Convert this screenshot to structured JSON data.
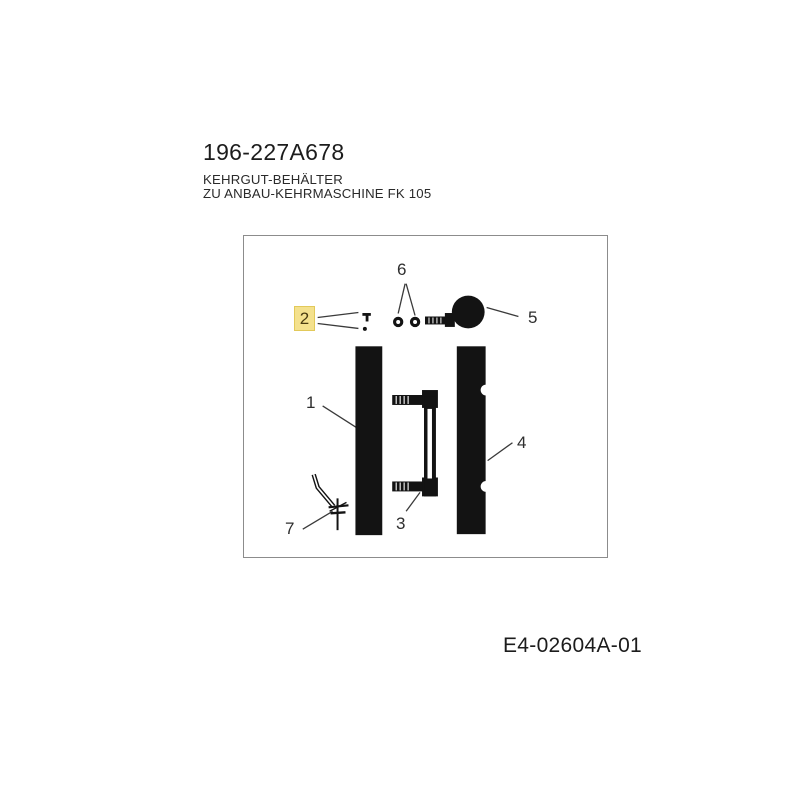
{
  "header": {
    "part_number": "196-227A678",
    "description_lines": [
      "KEHRGUT-BEHÄLTER",
      "ZU ANBAU-KEHRMASCHINE FK 105"
    ]
  },
  "diagram": {
    "callouts": [
      {
        "label": "1",
        "highlighted": false
      },
      {
        "label": "2",
        "highlighted": true
      },
      {
        "label": "3",
        "highlighted": false
      },
      {
        "label": "4",
        "highlighted": false
      },
      {
        "label": "5",
        "highlighted": false
      },
      {
        "label": "6",
        "highlighted": false
      },
      {
        "label": "7",
        "highlighted": false
      }
    ],
    "selected_callout": "2"
  },
  "footer": {
    "drawing_number": "E4-02604A-01"
  },
  "colors": {
    "highlight_bg": "#f4e18d",
    "highlight_border": "#e2c95a",
    "ink": "#1f1f1f",
    "box_border": "#8c8c8c",
    "drawing_black": "#131313"
  }
}
